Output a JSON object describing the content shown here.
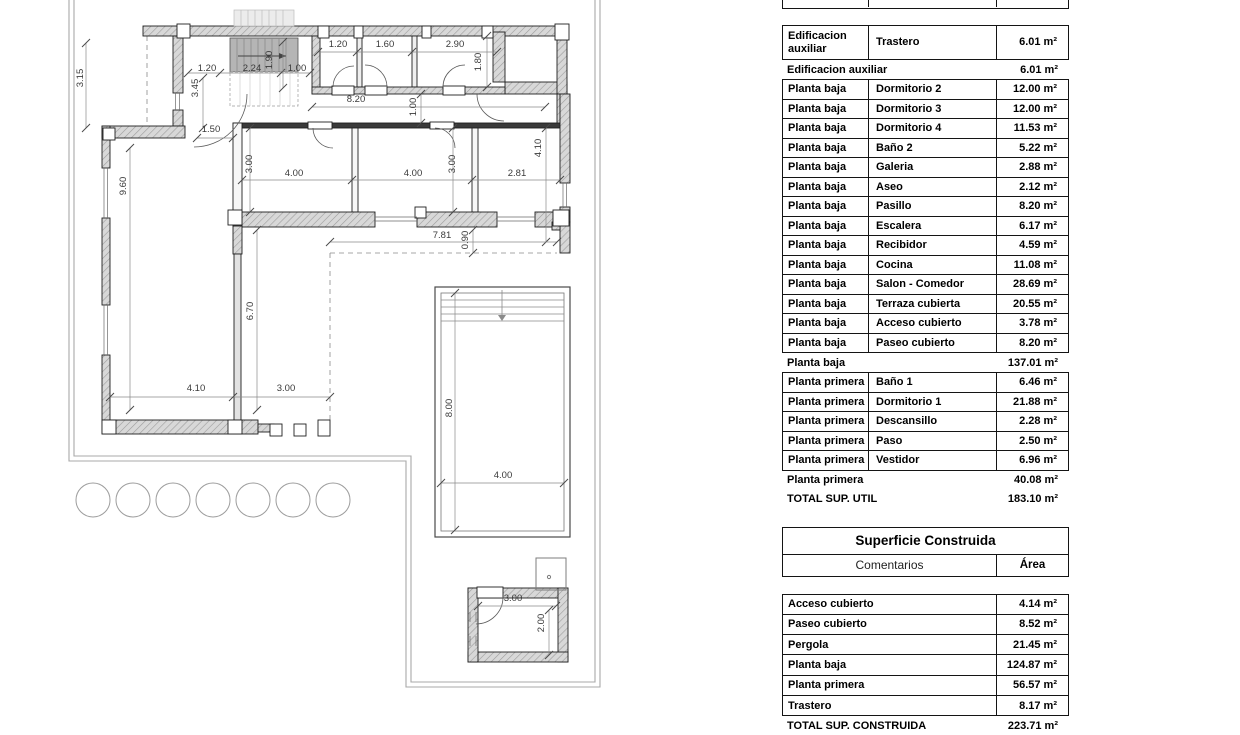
{
  "plan": {
    "dimensions": [
      {
        "label": "3.15",
        "x": 83,
        "y": 78,
        "rot": -90
      },
      {
        "label": "1.20",
        "x": 207,
        "y": 71,
        "rot": 0
      },
      {
        "label": "3.45",
        "x": 198,
        "y": 88,
        "rot": -90
      },
      {
        "label": "2.24",
        "x": 252,
        "y": 71,
        "rot": 0
      },
      {
        "label": "1.90",
        "x": 272,
        "y": 60,
        "rot": -90
      },
      {
        "label": "1.00",
        "x": 297,
        "y": 71,
        "rot": 0
      },
      {
        "label": "1.20",
        "x": 338,
        "y": 47,
        "rot": 0
      },
      {
        "label": "1.60",
        "x": 385,
        "y": 47,
        "rot": 0
      },
      {
        "label": "2.90",
        "x": 455,
        "y": 47,
        "rot": 0
      },
      {
        "label": "1.80",
        "x": 481,
        "y": 62,
        "rot": -90
      },
      {
        "label": "8.20",
        "x": 356,
        "y": 102,
        "rot": 0
      },
      {
        "label": "1.00",
        "x": 416,
        "y": 107,
        "rot": -90
      },
      {
        "label": "1.50",
        "x": 211,
        "y": 132,
        "rot": 0
      },
      {
        "label": "3.00",
        "x": 252,
        "y": 164,
        "rot": -90
      },
      {
        "label": "4.00",
        "x": 294,
        "y": 176,
        "rot": 0
      },
      {
        "label": "3.00",
        "x": 455,
        "y": 164,
        "rot": -90
      },
      {
        "label": "4.00",
        "x": 413,
        "y": 176,
        "rot": 0
      },
      {
        "label": "2.81",
        "x": 517,
        "y": 176,
        "rot": 0
      },
      {
        "label": "4.10",
        "x": 541,
        "y": 148,
        "rot": -90
      },
      {
        "label": "9.60",
        "x": 126,
        "y": 186,
        "rot": -90
      },
      {
        "label": "6.70",
        "x": 253,
        "y": 311,
        "rot": -90
      },
      {
        "label": "4.10",
        "x": 196,
        "y": 391,
        "rot": 0
      },
      {
        "label": "3.00",
        "x": 286,
        "y": 391,
        "rot": 0
      },
      {
        "label": "7.81",
        "x": 442,
        "y": 238,
        "rot": 0
      },
      {
        "label": "0.90",
        "x": 468,
        "y": 240,
        "rot": -90
      },
      {
        "label": "8.00",
        "x": 452,
        "y": 408,
        "rot": -90
      },
      {
        "label": "4.00",
        "x": 503,
        "y": 478,
        "rot": 0
      },
      {
        "label": "3.00",
        "x": 513,
        "y": 601,
        "rot": 0
      },
      {
        "label": "2.00",
        "x": 544,
        "y": 623,
        "rot": -90
      }
    ]
  },
  "tables": {
    "superficie_util": {
      "columns": [
        "Nivel",
        "Nombre",
        "Área"
      ],
      "groups": [
        {
          "rows": [
            [
              "Edificacion auxiliar",
              "Trastero",
              "6.01 m²"
            ]
          ],
          "subtotal": {
            "label": "Edificacion auxiliar",
            "value": "6.01 m²"
          }
        },
        {
          "rows": [
            [
              "Planta baja",
              "Dormitorio 2",
              "12.00 m²"
            ],
            [
              "Planta baja",
              "Dormitorio 3",
              "12.00 m²"
            ],
            [
              "Planta baja",
              "Dormitorio 4",
              "11.53 m²"
            ],
            [
              "Planta baja",
              "Baño 2",
              "5.22 m²"
            ],
            [
              "Planta baja",
              "Galeria",
              "2.88 m²"
            ],
            [
              "Planta baja",
              "Aseo",
              "2.12 m²"
            ],
            [
              "Planta baja",
              "Pasillo",
              "8.20 m²"
            ],
            [
              "Planta baja",
              "Escalera",
              "6.17 m²"
            ],
            [
              "Planta baja",
              "Recibidor",
              "4.59 m²"
            ],
            [
              "Planta baja",
              "Cocina",
              "11.08 m²"
            ],
            [
              "Planta baja",
              "Salon - Comedor",
              "28.69 m²"
            ],
            [
              "Planta baja",
              "Terraza cubierta",
              "20.55 m²"
            ],
            [
              "Planta baja",
              "Acceso cubierto",
              "3.78 m²"
            ],
            [
              "Planta baja",
              "Paseo cubierto",
              "8.20 m²"
            ]
          ],
          "subtotal": {
            "label": "Planta baja",
            "value": "137.01 m²"
          }
        },
        {
          "rows": [
            [
              "Planta primera",
              "Baño 1",
              "6.46 m²"
            ],
            [
              "Planta primera",
              "Dormitorio 1",
              "21.88 m²"
            ],
            [
              "Planta primera",
              "Descansillo",
              "2.28 m²"
            ],
            [
              "Planta primera",
              "Paso",
              "2.50 m²"
            ],
            [
              "Planta primera",
              "Vestidor",
              "6.96 m²"
            ]
          ],
          "subtotal": {
            "label": "Planta primera",
            "value": "40.08 m²"
          }
        }
      ],
      "total": {
        "label": "TOTAL SUP. UTIL",
        "value": "183.10 m²"
      }
    },
    "superficie_construida": {
      "title": "Superficie Construida",
      "columns": [
        "Comentarios",
        "Área"
      ],
      "rows": [
        [
          "Acceso cubierto",
          "4.14 m²"
        ],
        [
          "Paseo cubierto",
          "8.52 m²"
        ],
        [
          "Pergola",
          "21.45 m²"
        ],
        [
          "Planta baja",
          "124.87 m²"
        ],
        [
          "Planta primera",
          "56.57 m²"
        ],
        [
          "Trastero",
          "8.17 m²"
        ]
      ],
      "total": {
        "label": "TOTAL SUP. CONSTRUIDA",
        "value": "223.71 m²"
      }
    }
  }
}
